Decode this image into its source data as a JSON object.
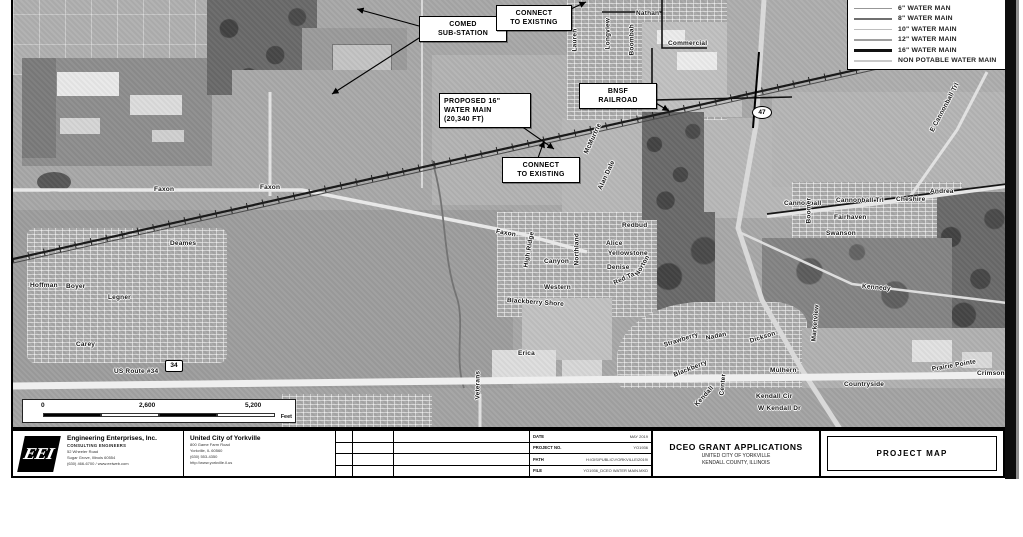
{
  "legend": {
    "items": [
      {
        "label": "6\" WATER MAN",
        "color": "#979797",
        "weight": 1
      },
      {
        "label": "8\" WATER MAIN",
        "color": "#6f6f6f",
        "weight": 2
      },
      {
        "label": "10\" WATER MAIN",
        "color": "#bdbdbd",
        "weight": 1
      },
      {
        "label": "12\" WATER MAIN",
        "color": "#9e9e9e",
        "weight": 2
      },
      {
        "label": "16\" WATER MAIN",
        "color": "#111111",
        "weight": 3
      },
      {
        "label": "NON POTABLE WATER MAIN",
        "color": "#c9c9c9",
        "weight": 2
      }
    ]
  },
  "callouts": [
    {
      "id": "comed",
      "text": "COMED\nSUB-STATION"
    },
    {
      "id": "connect-existing-top",
      "text": "CONNECT\nTO EXISTING"
    },
    {
      "id": "proposed-main",
      "text": "PROPOSED 16\"\nWATER MAIN\n(20,340 FT)"
    },
    {
      "id": "bnsf-railroad",
      "text": "BNSF\nRAILROAD"
    },
    {
      "id": "connect-existing-mid",
      "text": "CONNECT\nTO EXISTING"
    }
  ],
  "shields": {
    "route47": "47",
    "route34": "34"
  },
  "scalebar": {
    "start": "0",
    "mid": "2,600",
    "end": "5,200",
    "unit": "Feet"
  },
  "map_labels": [
    {
      "text": "Faxon",
      "x": 152,
      "y": 186,
      "r": 0
    },
    {
      "text": "Faxon",
      "x": 258,
      "y": 184,
      "r": 0
    },
    {
      "text": "Faxon",
      "x": 494,
      "y": 228,
      "r": 10
    },
    {
      "text": "Hoffman",
      "x": 28,
      "y": 282,
      "r": 0
    },
    {
      "text": "Boyer",
      "x": 64,
      "y": 283,
      "r": 0
    },
    {
      "text": "Legner",
      "x": 106,
      "y": 294,
      "r": 0
    },
    {
      "text": "Deames",
      "x": 168,
      "y": 240,
      "r": 0
    },
    {
      "text": "Carey",
      "x": 74,
      "y": 341,
      "r": 0
    },
    {
      "text": "Nathan",
      "x": 634,
      "y": 10,
      "r": 0
    },
    {
      "text": "Commercial",
      "x": 666,
      "y": 40,
      "r": 0
    },
    {
      "text": "Boombah",
      "x": 630,
      "y": 52,
      "r": -90
    },
    {
      "text": "Lauren",
      "x": 573,
      "y": 48,
      "r": -90
    },
    {
      "text": "Longview",
      "x": 606,
      "y": 46,
      "r": -90
    },
    {
      "text": "McMurtrie",
      "x": 584,
      "y": 150,
      "r": -65
    },
    {
      "text": "Alan Dale",
      "x": 598,
      "y": 186,
      "r": -65
    },
    {
      "text": "Redbud",
      "x": 620,
      "y": 222,
      "r": 0
    },
    {
      "text": "Alice",
      "x": 604,
      "y": 240,
      "r": 0
    },
    {
      "text": "Yellowstone",
      "x": 606,
      "y": 250,
      "r": 0
    },
    {
      "text": "Canyon",
      "x": 542,
      "y": 258,
      "r": 0
    },
    {
      "text": "High Ridge",
      "x": 524,
      "y": 264,
      "r": -80
    },
    {
      "text": "Denise",
      "x": 605,
      "y": 264,
      "r": 0
    },
    {
      "text": "Northland",
      "x": 575,
      "y": 262,
      "r": -90
    },
    {
      "text": "Western",
      "x": 542,
      "y": 284,
      "r": 0
    },
    {
      "text": "Red Tail",
      "x": 612,
      "y": 280,
      "r": -25
    },
    {
      "text": "Norton",
      "x": 635,
      "y": 272,
      "r": -60
    },
    {
      "text": "Blackberry Shore",
      "x": 505,
      "y": 297,
      "r": 4
    },
    {
      "text": "Erica",
      "x": 516,
      "y": 350,
      "r": 0
    },
    {
      "text": "Veterans",
      "x": 476,
      "y": 396,
      "r": -90
    },
    {
      "text": "US Route #34",
      "x": 112,
      "y": 368,
      "r": 0
    },
    {
      "text": "Cannonball",
      "x": 782,
      "y": 200,
      "r": 0
    },
    {
      "text": "Cannonball Trl",
      "x": 834,
      "y": 197,
      "r": 0
    },
    {
      "text": "Cheshire",
      "x": 894,
      "y": 196,
      "r": 0
    },
    {
      "text": "Andrea",
      "x": 928,
      "y": 188,
      "r": 0
    },
    {
      "text": "Fairhaven",
      "x": 832,
      "y": 214,
      "r": 0
    },
    {
      "text": "Swanson",
      "x": 824,
      "y": 230,
      "r": 0
    },
    {
      "text": "Boomer",
      "x": 807,
      "y": 220,
      "r": -90
    },
    {
      "text": "Kennedy",
      "x": 860,
      "y": 283,
      "r": 5
    },
    {
      "text": "E Cannonball Trl",
      "x": 930,
      "y": 128,
      "r": -62
    },
    {
      "text": "Strawberry",
      "x": 662,
      "y": 342,
      "r": -18
    },
    {
      "text": "Nadan",
      "x": 704,
      "y": 335,
      "r": -12
    },
    {
      "text": "Dickson",
      "x": 748,
      "y": 338,
      "r": -18
    },
    {
      "text": "Blackberry",
      "x": 672,
      "y": 372,
      "r": -22
    },
    {
      "text": "Mulhern",
      "x": 768,
      "y": 367,
      "r": 0
    },
    {
      "text": "Countryside",
      "x": 842,
      "y": 381,
      "r": 0
    },
    {
      "text": "Kendall Cir",
      "x": 754,
      "y": 393,
      "r": 0
    },
    {
      "text": "W Kendall Dr",
      "x": 756,
      "y": 405,
      "r": 0
    },
    {
      "text": "Kendall",
      "x": 694,
      "y": 402,
      "r": -48
    },
    {
      "text": "Center",
      "x": 720,
      "y": 392,
      "r": -85
    },
    {
      "text": "Marketview",
      "x": 812,
      "y": 338,
      "r": -85
    },
    {
      "text": "Prairie Pointe",
      "x": 930,
      "y": 366,
      "r": -10
    },
    {
      "text": "Crimson",
      "x": 975,
      "y": 370,
      "r": 0
    }
  ],
  "titleblock": {
    "eei": {
      "logo": "EEI",
      "name": "Engineering Enterprises, Inc.",
      "tagline": "CONSULTING ENGINEERS",
      "address1": "52 Wheeler Road",
      "address2": "Sugar Grove, Illinois 60554",
      "address3": "(630) 466-6700 / www.eeiweb.com"
    },
    "client": {
      "name": "United City of Yorkville",
      "address1": "800 Game Farm Road",
      "address2": "Yorkville, IL 60560",
      "address3": "(630) 553-4350",
      "address4": "http://www.yorkville.il.us"
    },
    "info": {
      "rows": [
        {
          "label": "DATE",
          "value": "MAY 2019"
        },
        {
          "label": "PROJECT NO.",
          "value": "YO1936"
        },
        {
          "label": "PATH",
          "value": "H:\\GIS\\PUBLIC\\YORKVILLE\\2019\\"
        },
        {
          "label": "FILE",
          "value": "YO1936_DCEO WATER MAIN.MXD"
        }
      ]
    },
    "project": {
      "title": "DCEO GRANT APPLICATIONS",
      "line2": "UNITED CITY OF YORKVILLE",
      "line3": "KENDALL COUNTY, ILLINOIS"
    },
    "sheet_title": "PROJECT MAP"
  }
}
